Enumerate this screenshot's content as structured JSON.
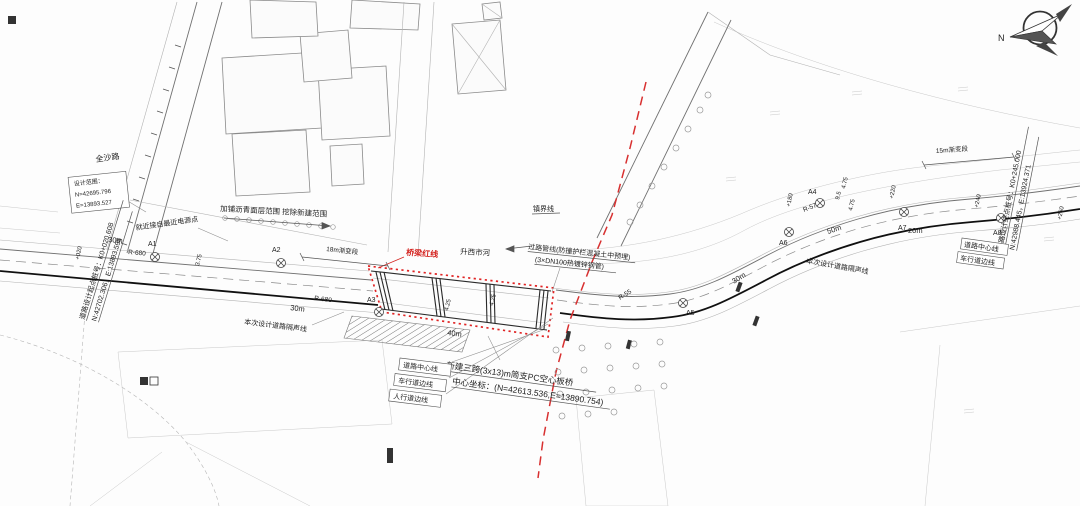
{
  "compass": {
    "north_label": "N"
  },
  "labels": {
    "quansha_road": "全沙路",
    "river_name": "升西市河",
    "town_boundary": "镇界线",
    "design_scope_title": "设计范围：",
    "design_scope_n": "N=42695.796",
    "design_scope_e": "E=13893.527",
    "power_note": "就近接自最近电源点",
    "asphalt_note": "加铺沥青面层范围 挖除新建范围",
    "start_station_line1": "道路设计起点桩号：K0+020.608",
    "start_station_line2": "N:42702.306，E:13893.598",
    "end_station_line1": "道路设计终点桩号：K0+245.000",
    "end_station_line2": "N:42988.445，E:13924.371",
    "bridge_redline": "桥梁红线",
    "pipeline_line1": "过路管线(防撞护栏混凝土中预埋)",
    "pipeline_line2": "(3×DN100热镀锌钢管)",
    "bridge_name_line1": "新建三跨(3x13)m简支PC空心板桥",
    "bridge_name_line2": "中心坐标：(N=42613.536,E=13890.754)",
    "noise_line": "本次设计道路隔声线",
    "road_centerline": "道路中心线",
    "carriageway_edge": "车行道边线",
    "sidewalk_edge": "人行道边线",
    "transition_18m": "18m渐变段",
    "transition_15m": "15m渐变段"
  },
  "annotations": {
    "curve_points": [
      "A1",
      "A2",
      "A3",
      "A4",
      "A5",
      "A6",
      "A7",
      "A8"
    ],
    "radii": [
      "R-680",
      "R-680",
      "R-55",
      "R-57"
    ],
    "distances": [
      "30m",
      "30m",
      "40m",
      "30m",
      "50m",
      "20m"
    ],
    "chainages": [
      "+020",
      "+180",
      "+220",
      "+240",
      "+260"
    ],
    "dimensions": [
      "3.75",
      "4.25",
      "4.25",
      "4.75",
      "9.5",
      "4.75"
    ]
  }
}
